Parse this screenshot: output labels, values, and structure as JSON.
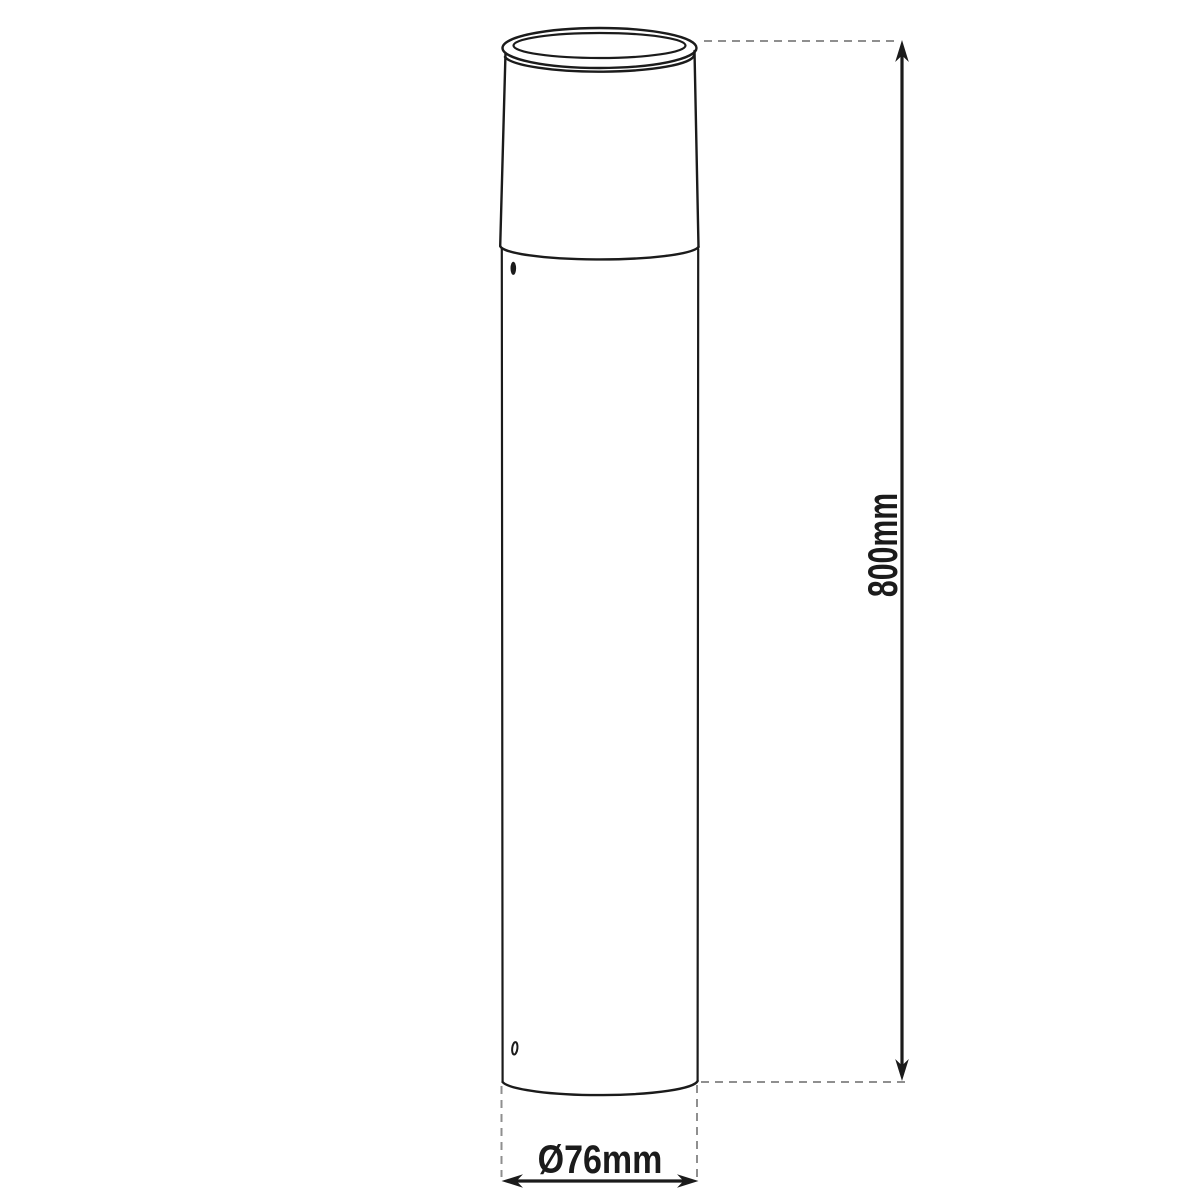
{
  "diagram": {
    "kind": "technical-dimension-drawing",
    "subject": "cylindrical bollard post light, front elevation",
    "labels": {
      "height": "800mm",
      "diameter": "Ø76mm"
    },
    "colors": {
      "background": "#ffffff",
      "outline": "#1b1b1b",
      "dimension_line": "#1b1b1b",
      "extension_line": "#8f8f8f"
    },
    "icons": {
      "height_arrows": "up-and-down filled arrowheads",
      "diameter_arrows": "left-and-right filled arrowheads"
    }
  }
}
